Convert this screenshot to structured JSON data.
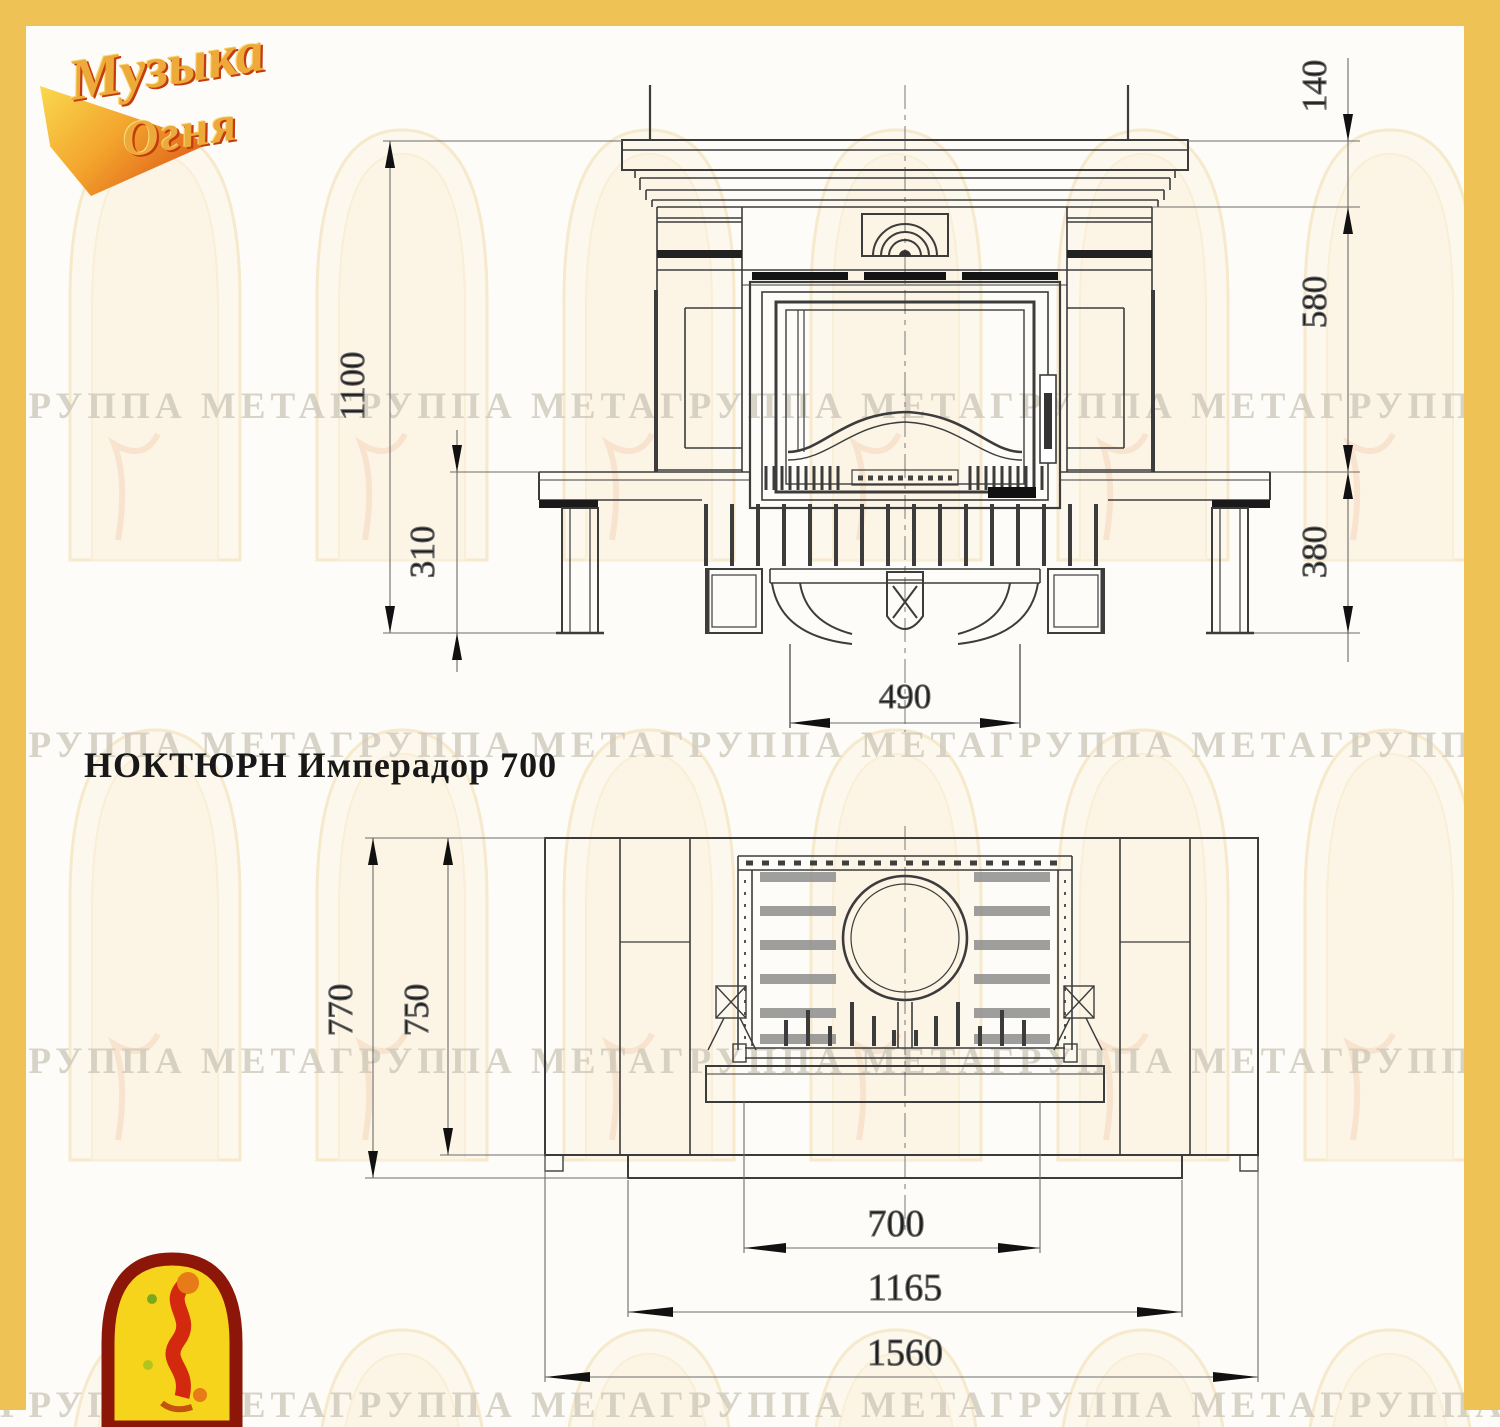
{
  "title": "НОКТЮРН Имперадор 700",
  "logo": {
    "line1": "Музыка",
    "line2": "Огня"
  },
  "watermark": {
    "text": "ГРУППА МЕТАГРУППА МЕТАГРУППА МЕТАГРУППА МЕТАГРУППА МЕТА"
  },
  "colors": {
    "border_accent": "#eec254",
    "drawing_line": "#3c3c3c",
    "dim_line": "#6b6b6b",
    "watermark_text": "#cfc9bb",
    "emblem_red": "#8c1708",
    "emblem_yellow": "#f6d41c"
  },
  "front_view": {
    "label": "front elevation of fireplace",
    "dims": {
      "total_height": "1100",
      "plinth_height": "310",
      "shelf_height": "140",
      "firebox_height": "580",
      "base_height": "380",
      "ash_opening_width": "490"
    }
  },
  "plan_view": {
    "label": "top plan of fireplace",
    "dims": {
      "total_depth": "770",
      "body_depth": "750",
      "firebox_width": "700",
      "inner_width": "1165",
      "total_width": "1560"
    }
  }
}
